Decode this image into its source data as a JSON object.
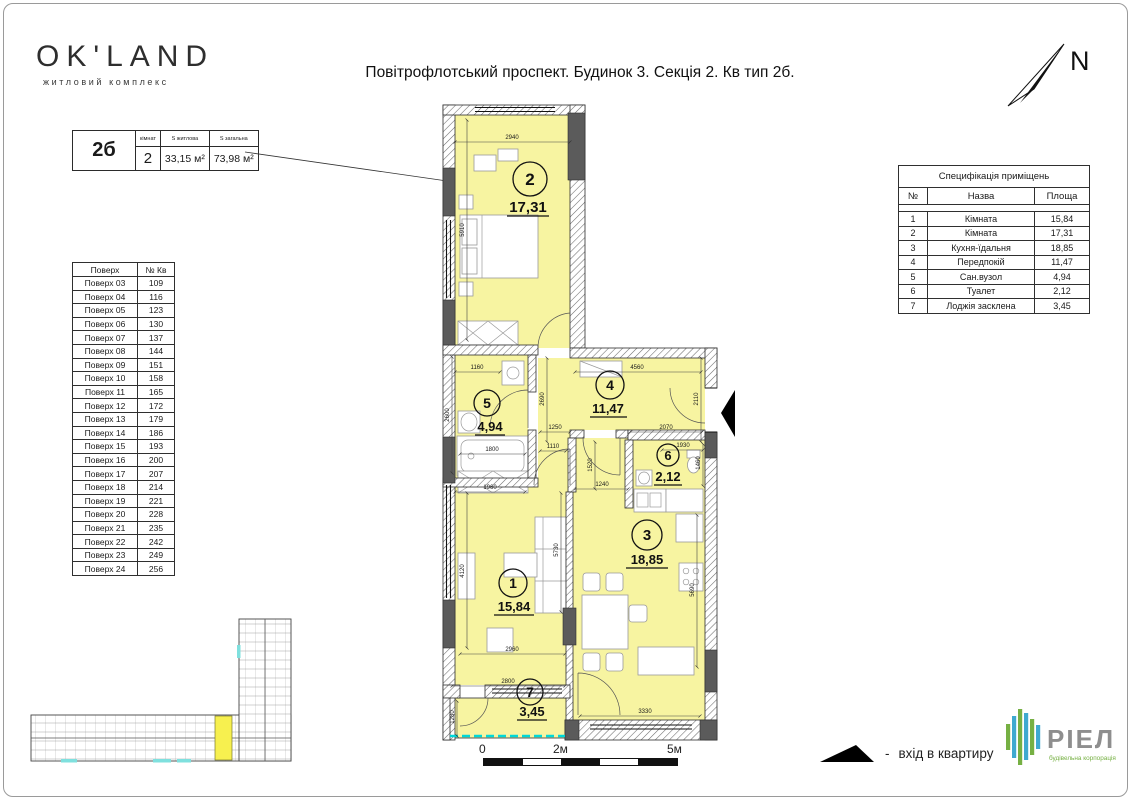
{
  "header": {
    "logo_name": "OK'LAND",
    "logo_subtitle": "житловий комплекс",
    "title": "Повітрофлотський проспект. Будинок 3. Секція 2. Кв тип 2б.",
    "north_label": "N"
  },
  "info_table": {
    "type_label": "2б",
    "col_rooms_header": "кімнат",
    "col_living_header": "S житлова",
    "col_total_header": "S загальна",
    "rooms": "2",
    "living_area": "33,15 м²",
    "total_area": "73,98 м²"
  },
  "floors_table": {
    "headers": [
      "Поверх",
      "№ Кв"
    ],
    "rows": [
      [
        "Поверх 03",
        "109"
      ],
      [
        "Поверх 04",
        "116"
      ],
      [
        "Поверх 05",
        "123"
      ],
      [
        "Поверх 06",
        "130"
      ],
      [
        "Поверх 07",
        "137"
      ],
      [
        "Поверх 08",
        "144"
      ],
      [
        "Поверх 09",
        "151"
      ],
      [
        "Поверх 10",
        "158"
      ],
      [
        "Поверх 11",
        "165"
      ],
      [
        "Поверх 12",
        "172"
      ],
      [
        "Поверх 13",
        "179"
      ],
      [
        "Поверх 14",
        "186"
      ],
      [
        "Поверх 15",
        "193"
      ],
      [
        "Поверх 16",
        "200"
      ],
      [
        "Поверх 17",
        "207"
      ],
      [
        "Поверх 18",
        "214"
      ],
      [
        "Поверх 19",
        "221"
      ],
      [
        "Поверх 20",
        "228"
      ],
      [
        "Поверх 21",
        "235"
      ],
      [
        "Поверх 22",
        "242"
      ],
      [
        "Поверх 23",
        "249"
      ],
      [
        "Поверх 24",
        "256"
      ]
    ]
  },
  "spec_table": {
    "title": "Специфікація приміщень",
    "headers": [
      "№",
      "Назва",
      "Площа"
    ],
    "rows": [
      [
        "1",
        "Кімната",
        "15,84"
      ],
      [
        "2",
        "Кімната",
        "17,31"
      ],
      [
        "3",
        "Кухня-їдальня",
        "18,85"
      ],
      [
        "4",
        "Передпокій",
        "11,47"
      ],
      [
        "5",
        "Сан.вузол",
        "4,94"
      ],
      [
        "6",
        "Туалет",
        "2,12"
      ],
      [
        "7",
        "Лоджія засклена",
        "3,45"
      ]
    ]
  },
  "plan": {
    "rooms": [
      {
        "number": "1",
        "area": "15,84"
      },
      {
        "number": "2",
        "area": "17,31"
      },
      {
        "number": "3",
        "area": "18,85"
      },
      {
        "number": "4",
        "area": "11,47"
      },
      {
        "number": "5",
        "area": "4,94"
      },
      {
        "number": "6",
        "area": "2,12"
      },
      {
        "number": "7",
        "area": "3,45"
      }
    ],
    "dims": [
      "2940",
      "5910",
      "1160",
      "2600",
      "1800",
      "1960",
      "2690",
      "4560",
      "2110",
      "1250",
      "2070",
      "1110",
      "1520",
      "1240",
      "1930",
      "1460",
      "5730",
      "4120",
      "2960",
      "2800",
      "1280",
      "5690",
      "3330"
    ]
  },
  "scale_bar": {
    "labels": [
      "0",
      "2м",
      "5м"
    ]
  },
  "legend": {
    "dash": "-",
    "entrance_label": "вхід в квартиру"
  },
  "riel": {
    "name": "РІЕЛ",
    "subtitle": "будівельна корпорація"
  },
  "colors": {
    "room_fill": "#F7F4A1",
    "wall_gray": "#5B5B5B",
    "glazing_cyan": "#00D8D8",
    "logo_green": "#76B043",
    "logo_blue": "#3FA9D0",
    "riel_text_gray": "#8E8E8E"
  }
}
